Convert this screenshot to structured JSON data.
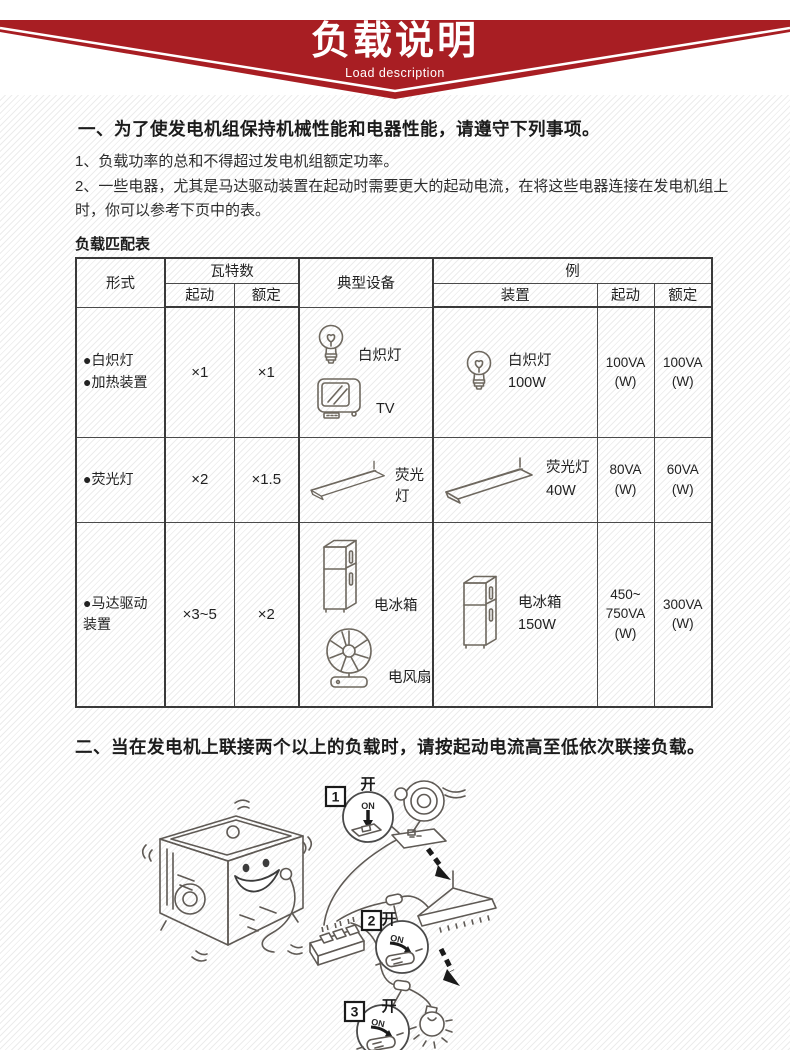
{
  "banner": {
    "title": "负载说明",
    "subtitle": "Load description",
    "color": "#a81e23"
  },
  "section1": {
    "heading": "一、为了使发电机组保持机械性能和电器性能，请遵守下列事项。",
    "items": [
      "1、负载功率的总和不得超过发电机组额定功率。",
      "2、一些电器，尤其是马达驱动装置在起动时需要更大的起动电流，在将这些电器连接在发电机组上时，你可以参考下页中的表。"
    ]
  },
  "table": {
    "caption": "负载匹配表",
    "headers": {
      "form": "形式",
      "watts": "瓦特数",
      "start": "起动",
      "rated": "额定",
      "typical": "典型设备",
      "example": "例",
      "device": "装置",
      "ex_start": "起动",
      "ex_rated": "额定"
    },
    "rows": [
      {
        "form": [
          "●白炽灯",
          "●加热装置"
        ],
        "start": "×1",
        "rated": "×1",
        "typical": [
          {
            "icon": "bulb-icon",
            "label": "白炽灯"
          },
          {
            "icon": "tv-icon",
            "label": "TV"
          }
        ],
        "example": {
          "icon": "bulb-icon",
          "lines": [
            "白炽灯",
            "100W"
          ]
        },
        "ex_start": [
          "100VA",
          "(W)"
        ],
        "ex_rated": [
          "100VA",
          "(W)"
        ]
      },
      {
        "form": [
          "●荧光灯"
        ],
        "start": "×2",
        "rated": "×1.5",
        "typical": [
          {
            "icon": "fluorescent-icon",
            "label": "荧光灯"
          }
        ],
        "example": {
          "icon": "fluorescent-icon",
          "lines": [
            "荧光灯",
            "40W"
          ]
        },
        "ex_start": [
          "80VA",
          "(W)"
        ],
        "ex_rated": [
          "60VA",
          "(W)"
        ]
      },
      {
        "form": [
          "●马达驱动",
          "装置"
        ],
        "start": "×3~5",
        "rated": "×2",
        "typical": [
          {
            "icon": "fridge-icon",
            "label": "电冰箱"
          },
          {
            "icon": "fan-icon",
            "label": "电风扇"
          }
        ],
        "example": {
          "icon": "fridge-icon",
          "lines": [
            "电冰箱",
            "150W"
          ]
        },
        "ex_start": [
          "450~",
          "750VA",
          "(W)"
        ],
        "ex_rated": [
          "300VA",
          "(W)"
        ]
      }
    ]
  },
  "section2": {
    "heading": "二、当在发电机上联接两个以上的负载时，请按起动电流高至低依次联接负载。"
  },
  "illustration": {
    "steps": [
      {
        "num": "1",
        "switch_label": "开",
        "on_label": "ON"
      },
      {
        "num": "2",
        "switch_label": "开",
        "on_label": "ON"
      },
      {
        "num": "3",
        "switch_label": "开",
        "on_label": "ON"
      }
    ]
  }
}
